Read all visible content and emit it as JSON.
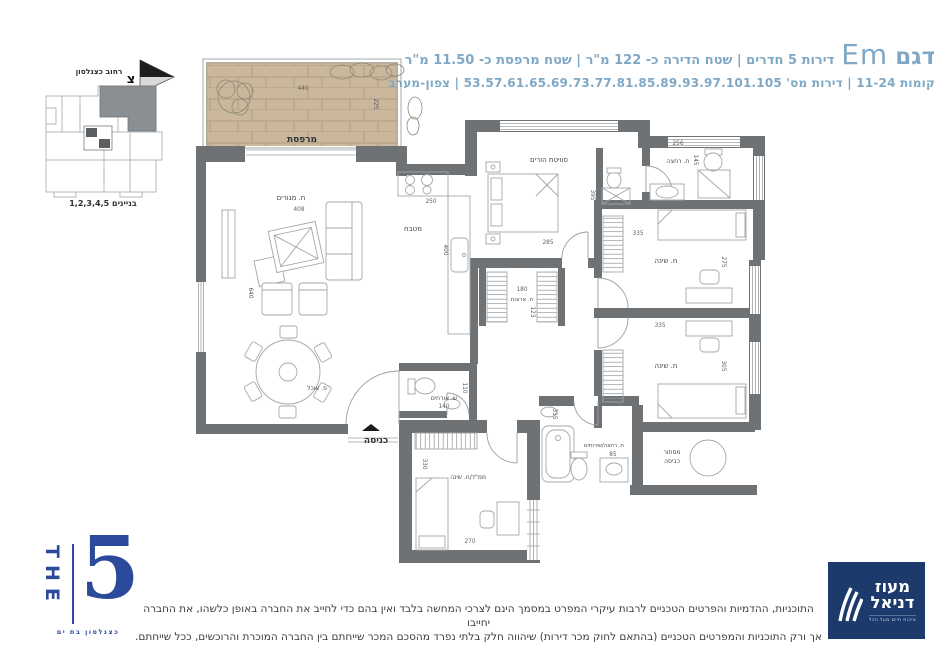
{
  "header": {
    "model_label": "דגם",
    "model_name": "Em",
    "specs": "דירות 5 חדרים | שטח הדירה כ- 122 מ\"ר | שטח מרפסת כ- 11.50 מ\"ר",
    "line2": "קומות 11-24  |  דירות מס' 53.57.61.65.69.73.77.81.85.89.93.97.101.105  |  צפון-מערב",
    "accent_color": "#7FA8C6"
  },
  "keyplan": {
    "street": "רחוב כצנלסון",
    "north_letter": "צ",
    "buildings": "בניינים 1,2,3,4,5"
  },
  "plan": {
    "balcony": {
      "label": "מרפסת",
      "w": "440",
      "h": "225"
    },
    "living": {
      "label": "ח. מגורים",
      "w": "408",
      "h": "640"
    },
    "dining": {
      "label": "פ. אוכל"
    },
    "kitchen": {
      "label": "מטבח",
      "w": "250",
      "h": "400"
    },
    "master": {
      "label": "סוויטת הורים",
      "w": "285",
      "h": "395"
    },
    "bath_top": {
      "label": "ח. רחצה",
      "w": "256",
      "h": "145"
    },
    "closets": {
      "label": "ח. ארונות",
      "w": "180",
      "h": "123"
    },
    "bedroom1": {
      "label": "ח. שינה",
      "w": "335",
      "h": "275"
    },
    "bedroom2": {
      "label": "ח. שינה",
      "w": "335",
      "h": "305"
    },
    "guest_wc": {
      "label": "ש. אורחים",
      "w": "140",
      "h": "110"
    },
    "entrance": {
      "label": "כניסה"
    },
    "mamad": {
      "label": "ממ\"ד/ח. שינה",
      "w": "270",
      "h": "330"
    },
    "bath_main": {
      "label": "ח. רחצה/שירותים",
      "w": "85",
      "h": "315"
    },
    "laundry": {
      "line1": "מסתור",
      "line2": "כביסה"
    }
  },
  "logo_the5": {
    "the": "THE",
    "five": "5",
    "sub": "כצנלסון בת ים"
  },
  "logo_dev": {
    "name1": "מעוז",
    "name2": "דניאל",
    "tagline": "איכות חיים מעל הכל"
  },
  "disclaimer": {
    "line1": "התוכניות, ההדמיות והפרטים הטכניים לרבות עיקרי המפרט במסמך הינם לצרכי המחשה בלבד ואין בהם כדי לחייב את החברה באופן כלשהו, את החברה יחייבו",
    "line2": "אך ורק התוכניות והמפרטים הטכניים (בהתאם לחוק מכר דירות) שיהווה חלק בלתי נפרד מהסכם המכר שייחתם בין החברה המוכרת והרוכשים, ככל שייחתם."
  }
}
